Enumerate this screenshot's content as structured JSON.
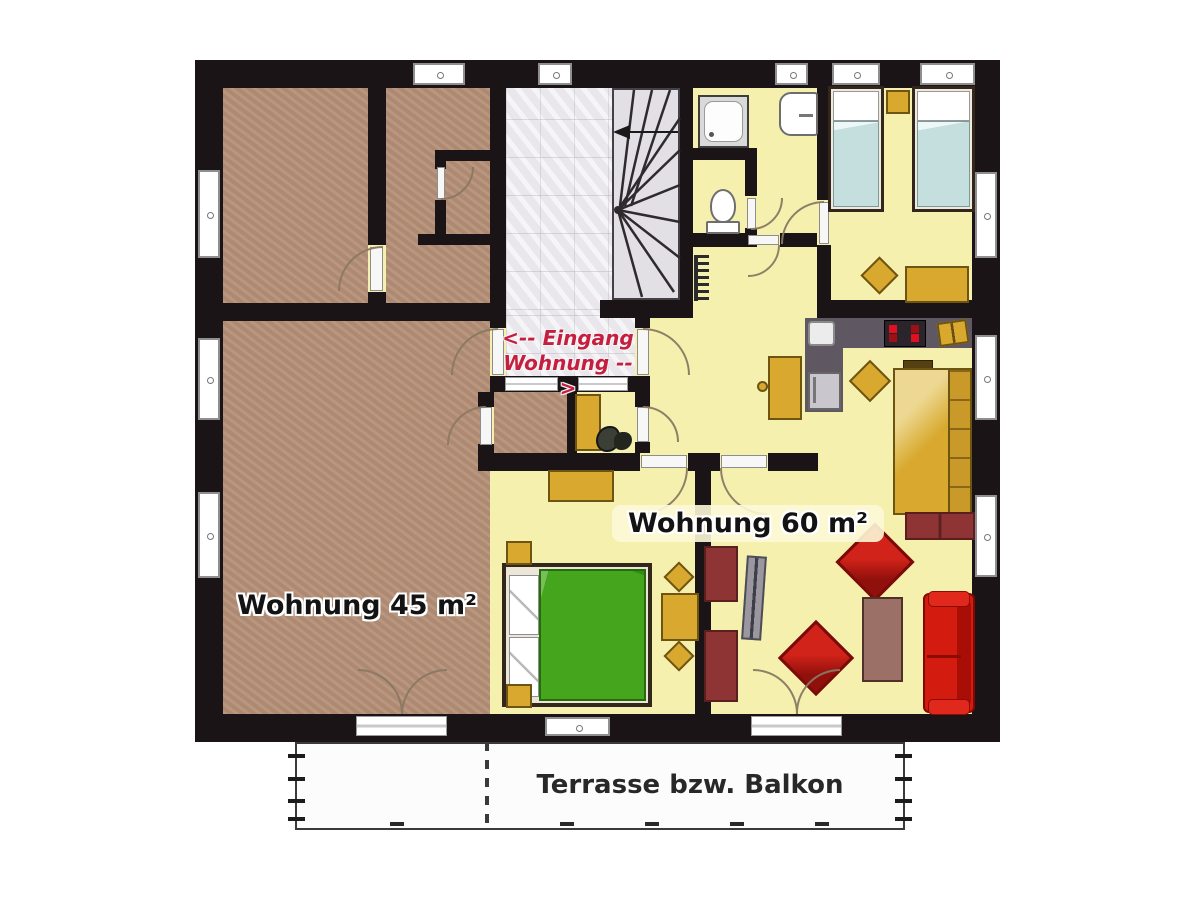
{
  "labels": {
    "apartment_small": "Wohnung 45 m²",
    "apartment_large": "Wohnung 60 m²",
    "entrance_line1": "<-- Eingang",
    "entrance_line2": "Wohnung -->",
    "terrace": "Terrasse bzw. Balkon"
  },
  "colors": {
    "wall": "#1a1416",
    "floor_small": "#b58f77",
    "floor_large": "#f6f0ae",
    "hall_floor": "#e9e7ec",
    "stair_floor": "#e2e0e5",
    "accent_red_text": "#c41f3e",
    "furniture_gold": "#d8a92e",
    "bed_green": "#45a51d",
    "bed_blue": "#c5dede",
    "sofa_red": "#d41b10",
    "chair_red": "#b01712",
    "sideboard_red": "#8e3434",
    "counter_gray": "#5f5862",
    "table_mauve": "#9b7066",
    "terrace_bg": "#fcfcfc"
  },
  "icons": {
    "stairs": "winder-staircase",
    "direction_arrow": "left-arrow",
    "bathtub_shower": "shower-tray",
    "toilet": "toilet",
    "sink": "wash-basin",
    "stove": "cooktop-4-burners",
    "fridge": "refrigerator",
    "radiator": "radiator",
    "plant": "potted-plant",
    "tv": "television"
  }
}
